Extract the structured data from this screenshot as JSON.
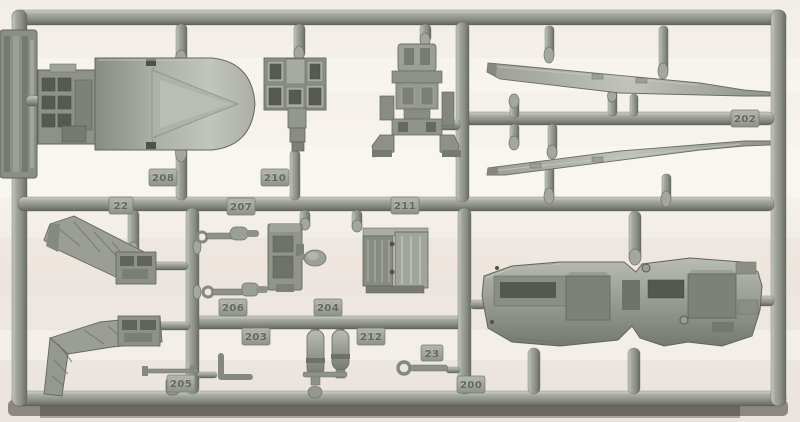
{
  "scene": {
    "subject": "Photograph of a gray injection-molded model aircraft kit sprue (parts runner) on a light background",
    "background_color": "#f3eee8",
    "plastic_color": "#989c93",
    "plastic_highlight": "#c6c9c2",
    "plastic_shadow": "#5d6157",
    "drop_shadow_color": "#3f3b33"
  },
  "tags": [
    {
      "label": "208",
      "location": "above main runner, upper left"
    },
    {
      "label": "210",
      "location": "above main runner, upper middle"
    },
    {
      "label": "22",
      "location": "on main runner, left"
    },
    {
      "label": "207",
      "location": "on main runner, left-center"
    },
    {
      "label": "211",
      "location": "on main runner, center"
    },
    {
      "label": "202",
      "location": "right horizontal runner, near right frame"
    },
    {
      "label": "206",
      "location": "above lower-left runner"
    },
    {
      "label": "204",
      "location": "above lower-left runner"
    },
    {
      "label": "203",
      "location": "below lower-left runner"
    },
    {
      "label": "212",
      "location": "below lower-left runner"
    },
    {
      "label": "23",
      "location": "lower center"
    },
    {
      "label": "205",
      "location": "above bottom frame, left"
    },
    {
      "label": "200",
      "location": "above bottom frame, center"
    }
  ],
  "parts": [
    {
      "id": "cowling",
      "name": "engine air-intake cowling with rear bulkhead detail",
      "location": "upper-left"
    },
    {
      "id": "instrument-panel",
      "name": "instrument panel block",
      "location": "top center-left"
    },
    {
      "id": "ejection-seat",
      "name": "ejection seat",
      "location": "top center"
    },
    {
      "id": "wing-upper",
      "name": "long tapered wing / stabilizer half",
      "location": "top right, upper"
    },
    {
      "id": "wing-lower",
      "name": "long tapered wing / stabilizer half (mirrored)",
      "location": "top right, lower"
    },
    {
      "id": "bulkhead-upper",
      "name": "angled truss bulkhead with box fitting",
      "location": "middle left"
    },
    {
      "id": "bulkhead-lower",
      "name": "angled truss bulkhead with box fitting (mirrored)",
      "location": "lower left"
    },
    {
      "id": "actuator-a",
      "name": "small actuator linkage",
      "location": "middle center-left"
    },
    {
      "id": "actuator-b",
      "name": "small actuator linkage",
      "location": "middle center-left"
    },
    {
      "id": "console",
      "name": "cockpit console sidewall with round knob",
      "location": "middle center"
    },
    {
      "id": "avionics-box",
      "name": "louvered avionics box",
      "location": "middle center"
    },
    {
      "id": "ordnance-a",
      "name": "small bomb / tank body",
      "location": "lower center"
    },
    {
      "id": "ordnance-b",
      "name": "small bomb / tank body",
      "location": "lower center"
    },
    {
      "id": "pitot",
      "name": "pitot probe and small cylinder",
      "location": "bottom left"
    },
    {
      "id": "tow-link",
      "name": "small ring-and-rod link",
      "location": "bottom center"
    },
    {
      "id": "bent-rod",
      "name": "L-bent rod",
      "location": "bottom left-center"
    },
    {
      "id": "cockpit-floor",
      "name": "large cockpit floor / fuselage deck",
      "location": "bottom right"
    }
  ],
  "id_tab": {
    "description": "embossed vertical maker tab on left frame edge, text illegible"
  }
}
